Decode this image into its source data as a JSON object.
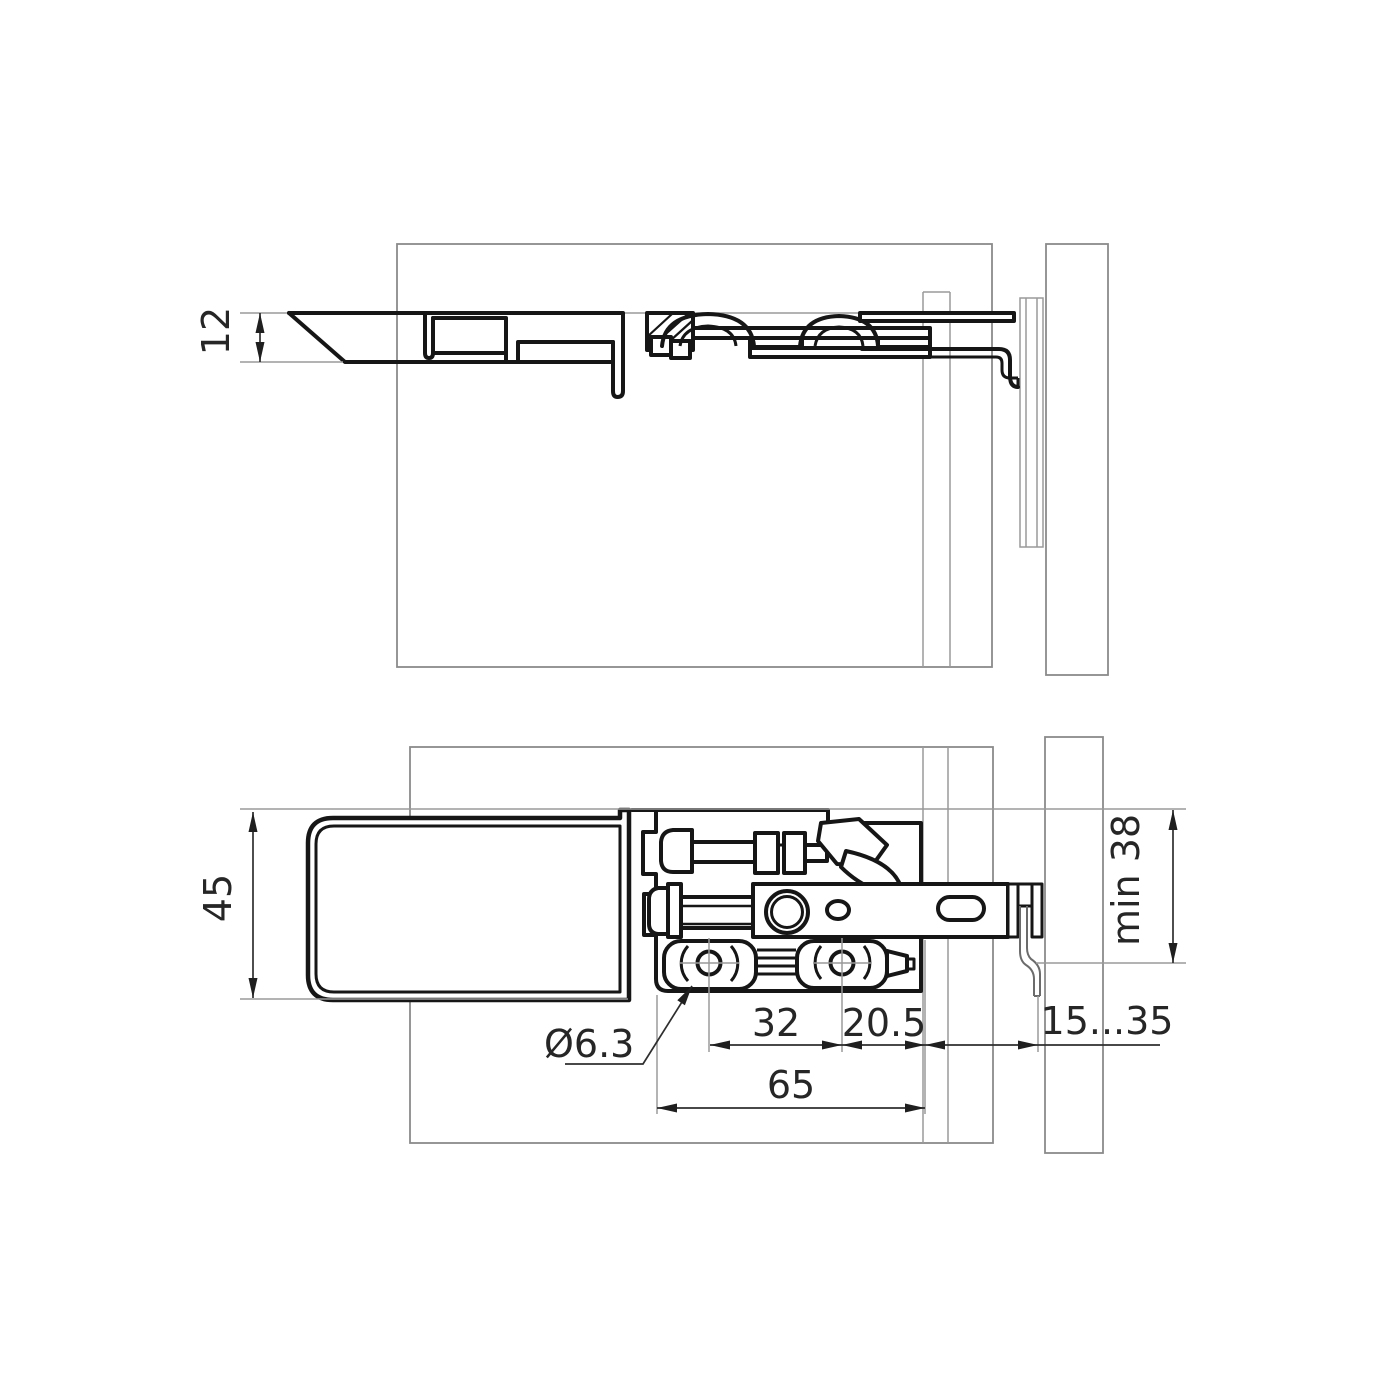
{
  "drawing": {
    "title": "panel hanger fitting - technical drawing, two section views",
    "colors": {
      "background": "#ffffff",
      "outline_thick": "#161616",
      "outline_thin": "#8a8a8a",
      "dimension_line": "#2e2e2e",
      "text": "#262626"
    },
    "dimensions": {
      "profile_thickness": {
        "label": "12"
      },
      "fixture_height": {
        "label": "45"
      },
      "hole_diameter": {
        "label": "Ø6.3"
      },
      "hole_pitch": {
        "label": "32"
      },
      "rear_offset": {
        "label": "20.5"
      },
      "base_length": {
        "label": "65"
      },
      "wall_clearance": {
        "label": "15...35"
      },
      "min_mount_height": {
        "label": "min 38"
      }
    }
  }
}
